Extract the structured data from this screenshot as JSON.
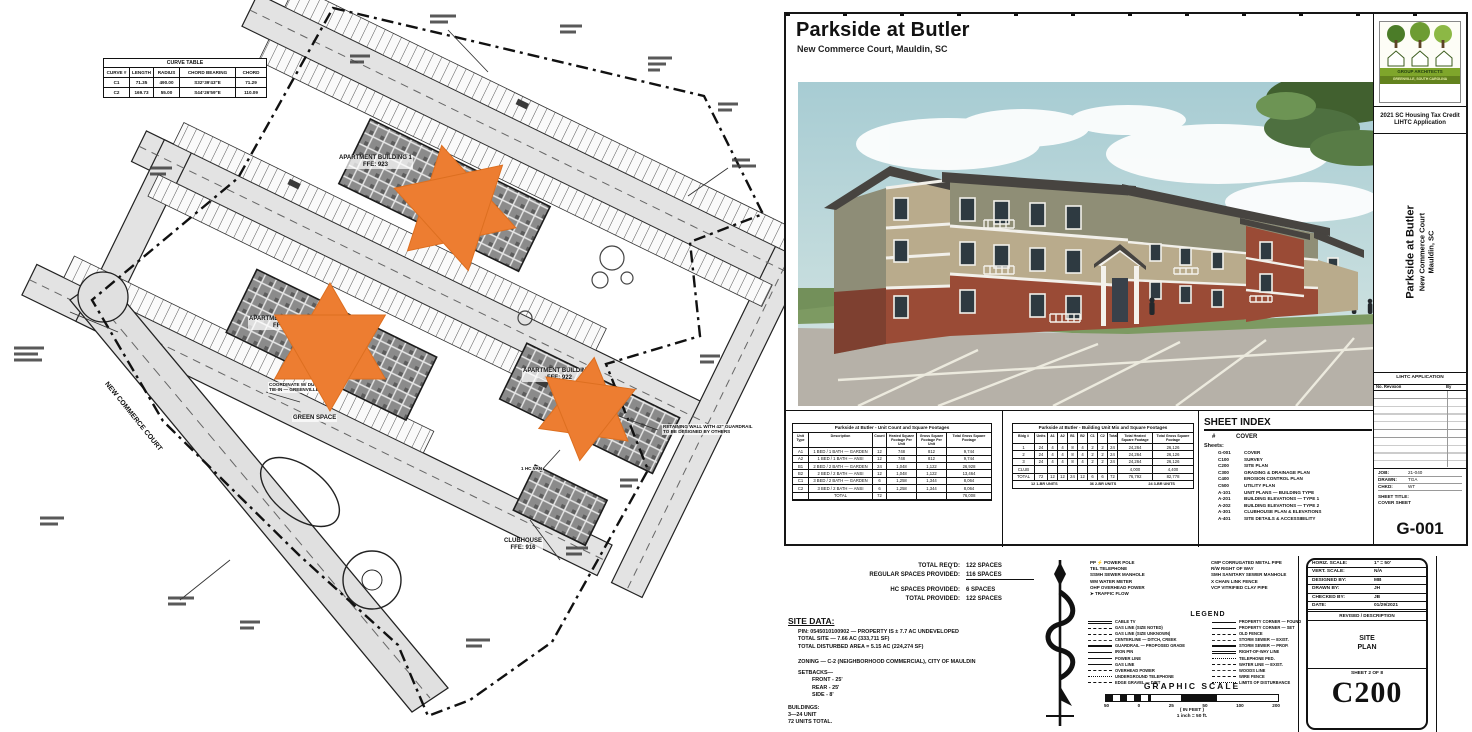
{
  "plan": {
    "curve_table": {
      "title": "CURVE TABLE",
      "headers": [
        "CURVE #",
        "LENGTH",
        "RADIUS",
        "CHORD BEARING",
        "CHORD"
      ],
      "rows": [
        [
          "C1",
          "71.35",
          "490.00",
          "S32°39'43\"E",
          "71.29"
        ],
        [
          "C2",
          "169.73",
          "55.00",
          "S44°26'59\"E",
          "110.09"
        ]
      ]
    },
    "labels": {
      "building1": "APARTMENT BUILDING 1",
      "building1_ffe": "FFE: 923",
      "building3": "APARTMENT BUILDING 3",
      "building3_ffe": "FFE: 921",
      "building2": "APARTMENT BUILDING 2",
      "building2_ffe": "FFE: 922",
      "green_space": "GREEN SPACE",
      "clubhouse": "CLUBHOUSE",
      "clubhouse_ffe": "FFE: 916",
      "street": "NEW COMMERCE COURT",
      "wall_note1": "RETAINING WALL WITH 42\" GUARDRAIL",
      "wall_note2": "TO BE DESIGNED BY OTHERS",
      "tiein_note1": "COORDINATE W/ DUKE ENERGY",
      "tiein_note2": "TIE-IN — GREENVILLE",
      "hc_note": "1 HC VAN"
    }
  },
  "cover": {
    "title": "Parkside at Butler",
    "subtitle": "New Commerce Court, Mauldin, SC",
    "unit_table": {
      "title": "Parkside at Butler - Unit Count and Square Footages",
      "headers": [
        "Unit Type",
        "Description",
        "Count",
        "Heated Square Footage Per Unit",
        "Gross Square Footage Per Unit",
        "Total Gross Square Footage"
      ],
      "rows": [
        [
          "A1",
          "1 BED / 1 BATH — GARDEN",
          "12",
          "748",
          "812",
          "9,744"
        ],
        [
          "A2",
          "1 BED / 1 BATH — ANSI",
          "12",
          "748",
          "812",
          "9,744"
        ],
        [
          "B1",
          "2 BED / 2 BATH — GARDEN",
          "24",
          "1,048",
          "1,122",
          "26,928"
        ],
        [
          "B2",
          "2 BED / 2 BATH — ANSI",
          "12",
          "1,048",
          "1,122",
          "13,464"
        ],
        [
          "C1",
          "3 BED / 2 BATH — GARDEN",
          "6",
          "1,258",
          "1,344",
          "8,064"
        ],
        [
          "C2",
          "3 BED / 2 BATH — ANSI",
          "6",
          "1,258",
          "1,344",
          "8,064"
        ],
        [
          "",
          "TOTAL",
          "72",
          "",
          "",
          "76,008"
        ]
      ]
    },
    "mix_table": {
      "title": "Parkside at Butler - Building Unit Mix and Square Footages",
      "headers": [
        "Bldg #",
        "Units",
        "A1",
        "A2",
        "B1",
        "B2",
        "C1",
        "C2",
        "Total",
        "Total Heated Square Footage",
        "Total Gross Square Footage"
      ],
      "rows": [
        [
          "1",
          "24",
          "4",
          "4",
          "8",
          "4",
          "2",
          "2",
          "24",
          "24,264",
          "26,126"
        ],
        [
          "2",
          "24",
          "4",
          "4",
          "8",
          "4",
          "2",
          "2",
          "24",
          "24,264",
          "26,126"
        ],
        [
          "3",
          "24",
          "4",
          "4",
          "8",
          "4",
          "2",
          "2",
          "24",
          "24,264",
          "26,126"
        ],
        [
          "CLUB",
          "",
          "",
          "",
          "",
          "",
          "",
          "",
          "",
          "4,000",
          "4,400"
        ],
        [
          "TOTAL",
          "72",
          "12",
          "12",
          "24",
          "12",
          "6",
          "6",
          "72",
          "76,792",
          "82,778"
        ]
      ],
      "notes": [
        "12 1-BR UNITS",
        "36 2-BR UNITS",
        "24 3-BR UNITS"
      ]
    },
    "sheet_index": {
      "title": "SHEET INDEX",
      "intro_no": "#",
      "intro_name": "COVER",
      "group": "Sheets:",
      "rows": [
        {
          "no": "G-001",
          "name": "COVER"
        },
        {
          "no": "C100",
          "name": "SURVEY"
        },
        {
          "no": "C200",
          "name": "SITE PLAN"
        },
        {
          "no": "C300",
          "name": "GRADING & DRAINAGE PLAN"
        },
        {
          "no": "C400",
          "name": "EROSION CONTROL PLAN"
        },
        {
          "no": "C500",
          "name": "UTILITY PLAN"
        },
        {
          "no": "A-101",
          "name": "UNIT PLANS — BUILDING TYPE"
        },
        {
          "no": "A-201",
          "name": "BUILDING ELEVATIONS — TYPE 1"
        },
        {
          "no": "A-202",
          "name": "BUILDING ELEVATIONS — TYPE 2"
        },
        {
          "no": "A-301",
          "name": "CLUBHOUSE PLAN & ELEVATIONS"
        },
        {
          "no": "A-401",
          "name": "SITE DETAILS & ACCESSIBILITY"
        }
      ]
    },
    "titleblock": {
      "firm": "GROUP ARCHITECTS",
      "firm_addr": "GREENVILLE, SOUTH CAROLINA",
      "credit1": "2021 SC Housing Tax Credit",
      "credit2": "LIHTC Application",
      "project": "Parkside at Butler",
      "project_sub1": "New Commerce Court",
      "project_sub2": "Mauldin, SC",
      "rev_note": "LIHTC APPLICATION",
      "rev_no_label": "No.  Revision",
      "rev_by_label": "By",
      "fields": [
        [
          "JOB:",
          "21-040"
        ],
        [
          "DRAWN:",
          "TGA"
        ],
        [
          "CHKD:",
          "WT"
        ]
      ],
      "sheet_title_label": "SHEET TITLE:",
      "sheet_title": "COVER SHEET",
      "sheet_no": "G-001"
    }
  },
  "c200": {
    "parking": [
      [
        "TOTAL REQ'D:",
        "122 SPACES"
      ],
      [
        "REGULAR SPACES PROVIDED:",
        "116 SPACES"
      ],
      [
        "HC SPACES PROVIDED:",
        "6 SPACES"
      ],
      [
        "TOTAL PROVIDED:",
        "122 SPACES"
      ]
    ],
    "site_data_title": "SITE DATA:",
    "site_data": [
      "PIN: 0545010100902 — PROPERTY IS ± 7.7 AC UNDEVELOPED",
      "TOTAL SITE — 7.66 AC (333,711 SF)",
      "TOTAL DISTURBED AREA = 5.15 AC (224,274 SF)",
      "",
      "ZONING — C-2 (NEIGHBORHOOD COMMERCIAL), CITY OF MAULDIN"
    ],
    "setbacks": [
      "SETBACKS—",
      "FRONT -  25'",
      "REAR -  25'",
      "SIDE -  8'"
    ],
    "buildings": [
      "BUILDINGS:",
      "3—24 UNIT",
      "72 UNITS TOTAL."
    ],
    "abbr_left": [
      "PP ⚡  POWER POLE",
      "TEL  TELEPHONE",
      "SSMH  SEWER MANHOLE",
      "WM  WATER METER",
      "OHP  OVERHEAD POWER",
      "➤  TRAFFIC FLOW"
    ],
    "abbr_right": [
      "CMP  CORRUGATED METAL PIPE",
      "R/W  RIGHT OF WAY",
      "SMH  SANITARY SEWER MANHOLE",
      "X  CHAIN LINK FENCE",
      "VCP  VITRIFIED CLAY PIPE"
    ],
    "legend_title": "LEGEND",
    "legend_left": [
      {
        "style": "ls-dbl",
        "label": "CABLE TV"
      },
      {
        "style": "ls-dash",
        "label": "GAS LINE (SIZE NOTED)"
      },
      {
        "style": "ls-dash",
        "label": "GAS LINE (SIZE UNKNOWN)"
      },
      {
        "style": "ls-dashdot",
        "label": "CENTERLINE — DITCH, CREEK"
      },
      {
        "style": "ls-thick",
        "label": "GUARDRAIL — PROPOSED GRADE"
      },
      {
        "style": "ls-solid",
        "label": "IRON PIN"
      },
      {
        "style": "ls-solid",
        "label": "POWER LINE"
      },
      {
        "style": "ls-solid",
        "label": "GAS LINE"
      },
      {
        "style": "ls-dash",
        "label": "OVERHEAD POWER"
      },
      {
        "style": "ls-dot",
        "label": "UNDERGROUND TELEPHONE"
      },
      {
        "style": "ls-dash",
        "label": "EDGE GRAVEL — DIRT"
      }
    ],
    "legend_right": [
      {
        "style": "ls-solid",
        "label": "PROPERTY CORNER — FOUND"
      },
      {
        "style": "ls-solid",
        "label": "PROPERTY CORNER — SET"
      },
      {
        "style": "ls-dash",
        "label": "OLD FENCE"
      },
      {
        "style": "ls-dashdot",
        "label": "STORM SEWER — EXIST."
      },
      {
        "style": "ls-thick",
        "label": "STORM SEWER — PROP."
      },
      {
        "style": "ls-dbl",
        "label": "RIGHT-OF-WAY LINE"
      },
      {
        "style": "ls-dot",
        "label": "TELEPHONE PED."
      },
      {
        "style": "ls-dash",
        "label": "WATER LINE — EXIST."
      },
      {
        "style": "ls-dashdot",
        "label": "WOODS LINE"
      },
      {
        "style": "ls-dash",
        "label": "WIRE FENCE"
      },
      {
        "style": "ls-dot",
        "label": "LIMITS OF DISTURBANCE"
      }
    ],
    "scale_title": "GRAPHIC SCALE",
    "scale_labels": [
      "50",
      "0",
      "25",
      "50",
      "100",
      "200"
    ],
    "scale_feet": "( IN FEET )",
    "scale_inch": "1 inch = 50 ft.",
    "titleblock": {
      "rows": [
        [
          "HORIZ. SCALE:",
          "1\" = 50'"
        ],
        [
          "VERT. SCALE:",
          "N/A"
        ],
        [
          "DESIGNED BY:",
          "MB"
        ],
        [
          "DRAWN BY:",
          "JH"
        ],
        [
          "CHECKED BY:",
          "JB"
        ],
        [
          "DATE:",
          "01/29/2021"
        ]
      ],
      "rev_band": "REVISED / DESCRIPTION",
      "title1": "SITE",
      "title2": "PLAN",
      "sheet_of": "SHEET 2 OF 8",
      "sheet_no": "C200"
    }
  },
  "colors": {
    "star_orange": "#ED7D31",
    "logo_green": "#7FA62B",
    "sky": "#AECDD3",
    "brick": "#9A4B36",
    "siding_olive": "#8F8E76",
    "siding_tan": "#B9AB8C",
    "roof": "#474440"
  }
}
